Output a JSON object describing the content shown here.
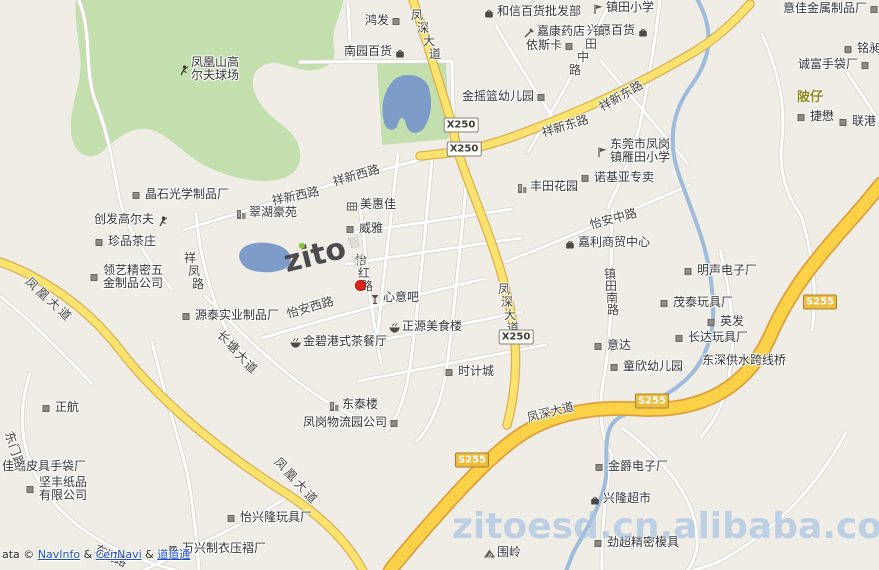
{
  "map": {
    "watermark_center": {
      "brand": "zito",
      "suffix": "智通"
    },
    "watermark_bottom": {
      "text": "zitoesd.cn.alibaba.com"
    },
    "attribution": {
      "prefix": "ata ©",
      "separator": "&",
      "links": [
        "NavInfo",
        "CenNavi",
        "道道通"
      ]
    },
    "marker": {
      "x": 359,
      "y": 284,
      "color": "#e0241b"
    },
    "place_labels": [
      {
        "text": "陂仔",
        "x": 797,
        "y": 86,
        "color": "#8f8a1e"
      }
    ],
    "route_badges": [
      {
        "text": "X250",
        "x": 461,
        "y": 125,
        "kind": "county"
      },
      {
        "text": "X250",
        "x": 464,
        "y": 149,
        "kind": "county"
      },
      {
        "text": "X250",
        "x": 516,
        "y": 337,
        "kind": "county"
      },
      {
        "text": "S255",
        "x": 820,
        "y": 302,
        "kind": "provincial"
      },
      {
        "text": "S255",
        "x": 652,
        "y": 401,
        "kind": "provincial"
      },
      {
        "text": "S255",
        "x": 472,
        "y": 460,
        "kind": "provincial"
      }
    ],
    "road_labels": [
      {
        "text": "凤深大道",
        "x": 417,
        "y": 6,
        "dx": 6,
        "dy": 13
      },
      {
        "text": "凤深大道",
        "x": 504,
        "y": 280,
        "dx": 3,
        "dy": 13
      },
      {
        "text": "凤深大道",
        "x": 527,
        "y": 409,
        "rot": -14
      },
      {
        "text": "祥新东路",
        "x": 542,
        "y": 124,
        "rot": -17
      },
      {
        "text": "祥新东路",
        "x": 600,
        "y": 99,
        "rot": -30
      },
      {
        "text": "祥新西路",
        "x": 272,
        "y": 192,
        "rot": -12
      },
      {
        "text": "祥新西路",
        "x": 333,
        "y": 173,
        "rot": -16
      },
      {
        "text": "怡安西路",
        "x": 287,
        "y": 305,
        "rot": -16
      },
      {
        "text": "怡安中路",
        "x": 590,
        "y": 216,
        "rot": -15
      },
      {
        "text": "祥凤路",
        "x": 190,
        "y": 249,
        "dx": 4,
        "dy": 13
      },
      {
        "text": "怡红路",
        "x": 361,
        "y": 251,
        "dx": 3,
        "dy": 13
      },
      {
        "text": "镇田中路",
        "x": 599,
        "y": 22,
        "dx": -8,
        "dy": 13
      },
      {
        "text": "镇田南路",
        "x": 610,
        "y": 265,
        "dx": 1,
        "dy": 12
      },
      {
        "text": "长塘大道",
        "x": 224,
        "y": 328,
        "dx": 9,
        "dy": 10,
        "cr": 40
      },
      {
        "text": "凤凰大道",
        "x": 32,
        "y": 275,
        "dx": 11,
        "dy": 10,
        "cr": 45
      },
      {
        "text": "凤凰大道",
        "x": 281,
        "y": 455,
        "dx": 10,
        "dy": 11,
        "cr": 45
      },
      {
        "text": "东门路",
        "x": 11,
        "y": 429,
        "dx": 4,
        "dy": 12,
        "cr": 70
      },
      {
        "text": "东门路",
        "x": 101,
        "y": 542,
        "dx": 10,
        "dy": 5,
        "cr": 25
      }
    ],
    "pois": [
      {
        "icon": "factory",
        "x": 397,
        "y": 22,
        "label": "鸿发",
        "side": "left"
      },
      {
        "icon": "bag",
        "x": 489,
        "y": 13,
        "label": "和信百货批发部",
        "side": "right"
      },
      {
        "icon": "school",
        "x": 598,
        "y": 9,
        "label": "镇田小学",
        "side": "right"
      },
      {
        "icon": "factory",
        "x": 875,
        "y": 10,
        "label": "意佳金属制品厂",
        "side": "left"
      },
      {
        "icon": "pharmacy",
        "x": 529,
        "y": 33,
        "label": "嘉康药店",
        "side": "right"
      },
      {
        "icon": "bag",
        "x": 643,
        "y": 32,
        "label": "兴惠百货",
        "side": "left"
      },
      {
        "icon": "bag",
        "x": 400,
        "y": 53,
        "label": "南园百货",
        "side": "left"
      },
      {
        "icon": "factory",
        "x": 570,
        "y": 47,
        "label": "依斯卡",
        "side": "left"
      },
      {
        "icon": "factory",
        "x": 849,
        "y": 50,
        "label": "铭昶",
        "side": "right"
      },
      {
        "icon": "golf",
        "x": 183,
        "y": 70,
        "label": "凤凰山高",
        "label2": "尔夫球场",
        "side": "right"
      },
      {
        "icon": "factory",
        "x": 542,
        "y": 98,
        "label": "金摇篮幼儿园",
        "side": "left"
      },
      {
        "icon": "factory",
        "x": 866,
        "y": 66,
        "label": "诚富手袋厂",
        "side": "left"
      },
      {
        "icon": "factory",
        "x": 802,
        "y": 118,
        "label": "捷懋",
        "side": "right"
      },
      {
        "icon": "factory",
        "x": 844,
        "y": 123,
        "label": "联港",
        "side": "right"
      },
      {
        "icon": "school",
        "x": 602,
        "y": 152,
        "label": "东莞市凤岗",
        "label2": "镇雁田小学",
        "side": "right"
      },
      {
        "icon": "building",
        "x": 522,
        "y": 188,
        "label": "丰田花园",
        "side": "right"
      },
      {
        "icon": "factory",
        "x": 586,
        "y": 179,
        "label": "诺基亚专卖",
        "side": "right"
      },
      {
        "icon": "factory",
        "x": 137,
        "y": 196,
        "label": "晶石光学制品厂",
        "side": "right"
      },
      {
        "icon": "golf",
        "x": 162,
        "y": 221,
        "label": "创发高尔夫",
        "side": "left"
      },
      {
        "icon": "building",
        "x": 241,
        "y": 214,
        "label": "翠湖豪苑",
        "side": "right"
      },
      {
        "icon": "factory",
        "x": 100,
        "y": 243,
        "label": "珍品茶庄",
        "side": "right"
      },
      {
        "icon": "shop",
        "x": 352,
        "y": 206,
        "label": "美惠佳",
        "side": "right"
      },
      {
        "icon": "factory",
        "x": 351,
        "y": 230,
        "label": "威雅",
        "side": "right"
      },
      {
        "icon": "bag",
        "x": 570,
        "y": 244,
        "label": "嘉利商贸中心",
        "side": "right"
      },
      {
        "icon": "factory",
        "x": 95,
        "y": 278,
        "label": "领艺精密五",
        "label2": "金制品公司",
        "side": "right"
      },
      {
        "icon": "factory",
        "x": 689,
        "y": 272,
        "label": "明声电子厂",
        "side": "right"
      },
      {
        "icon": "bar",
        "x": 375,
        "y": 299,
        "label": "心意吧",
        "side": "right"
      },
      {
        "icon": "factory",
        "x": 665,
        "y": 304,
        "label": "茂泰玩具厂",
        "side": "right"
      },
      {
        "icon": "factory",
        "x": 187,
        "y": 317,
        "label": "源泰实业制品厂",
        "side": "right"
      },
      {
        "icon": "restaurant",
        "x": 394,
        "y": 328,
        "label": "正源美食楼",
        "side": "right"
      },
      {
        "icon": "factory",
        "x": 712,
        "y": 323,
        "label": "英发",
        "side": "right"
      },
      {
        "icon": "factory",
        "x": 599,
        "y": 347,
        "label": "意达",
        "side": "right"
      },
      {
        "icon": "factory",
        "x": 680,
        "y": 339,
        "label": "长达玩具厂",
        "side": "right"
      },
      {
        "icon": "restaurant",
        "x": 295,
        "y": 343,
        "label": "金碧港式茶餐厅",
        "side": "right"
      },
      {
        "icon": "factory",
        "x": 450,
        "y": 373,
        "label": "时计城",
        "side": "right"
      },
      {
        "icon": "factory",
        "x": 615,
        "y": 368,
        "label": "童欣幼儿园",
        "side": "right"
      },
      {
        "icon": "none",
        "x": 700,
        "y": 362,
        "label": "东深供水跨线桥",
        "side": "right"
      },
      {
        "icon": "building",
        "x": 334,
        "y": 406,
        "label": "东泰楼",
        "side": "right"
      },
      {
        "icon": "factory",
        "x": 395,
        "y": 424,
        "label": "凤岗物流园公司",
        "side": "left"
      },
      {
        "icon": "factory",
        "x": 47,
        "y": 409,
        "label": "正航",
        "side": "right"
      },
      {
        "icon": "factory",
        "x": 600,
        "y": 468,
        "label": "金爵电子厂",
        "side": "right"
      },
      {
        "icon": "none",
        "x": 0,
        "y": 468,
        "label": "佳瑞皮具手袋厂",
        "side": "right"
      },
      {
        "icon": "factory",
        "x": 31,
        "y": 490,
        "label": "坚丰纸品",
        "label2": "有限公司",
        "side": "right"
      },
      {
        "icon": "bag",
        "x": 595,
        "y": 500,
        "label": "兴隆超市",
        "side": "right"
      },
      {
        "icon": "factory",
        "x": 232,
        "y": 519,
        "label": "怡兴隆玩具厂",
        "side": "right"
      },
      {
        "icon": "mountain",
        "x": 489,
        "y": 554,
        "label": "围岭",
        "side": "right"
      },
      {
        "icon": "factory",
        "x": 174,
        "y": 550,
        "label": "万兴制衣压褶厂",
        "side": "right"
      },
      {
        "icon": "factory",
        "x": 599,
        "y": 544,
        "label": "劲超精密模具",
        "side": "right"
      }
    ]
  },
  "colors": {
    "background": "#f0ede7",
    "road_yellow": "#fde36e",
    "highway_yellow": "#fbd147",
    "green_area": "#c2dfad",
    "water": "#7e9cc8",
    "river": "#9fbbdb",
    "marker_red": "#e0241b",
    "link_blue": "#1d4fd7",
    "watermark_blue": "#a8c3e2",
    "logo_green": "#76c524"
  }
}
